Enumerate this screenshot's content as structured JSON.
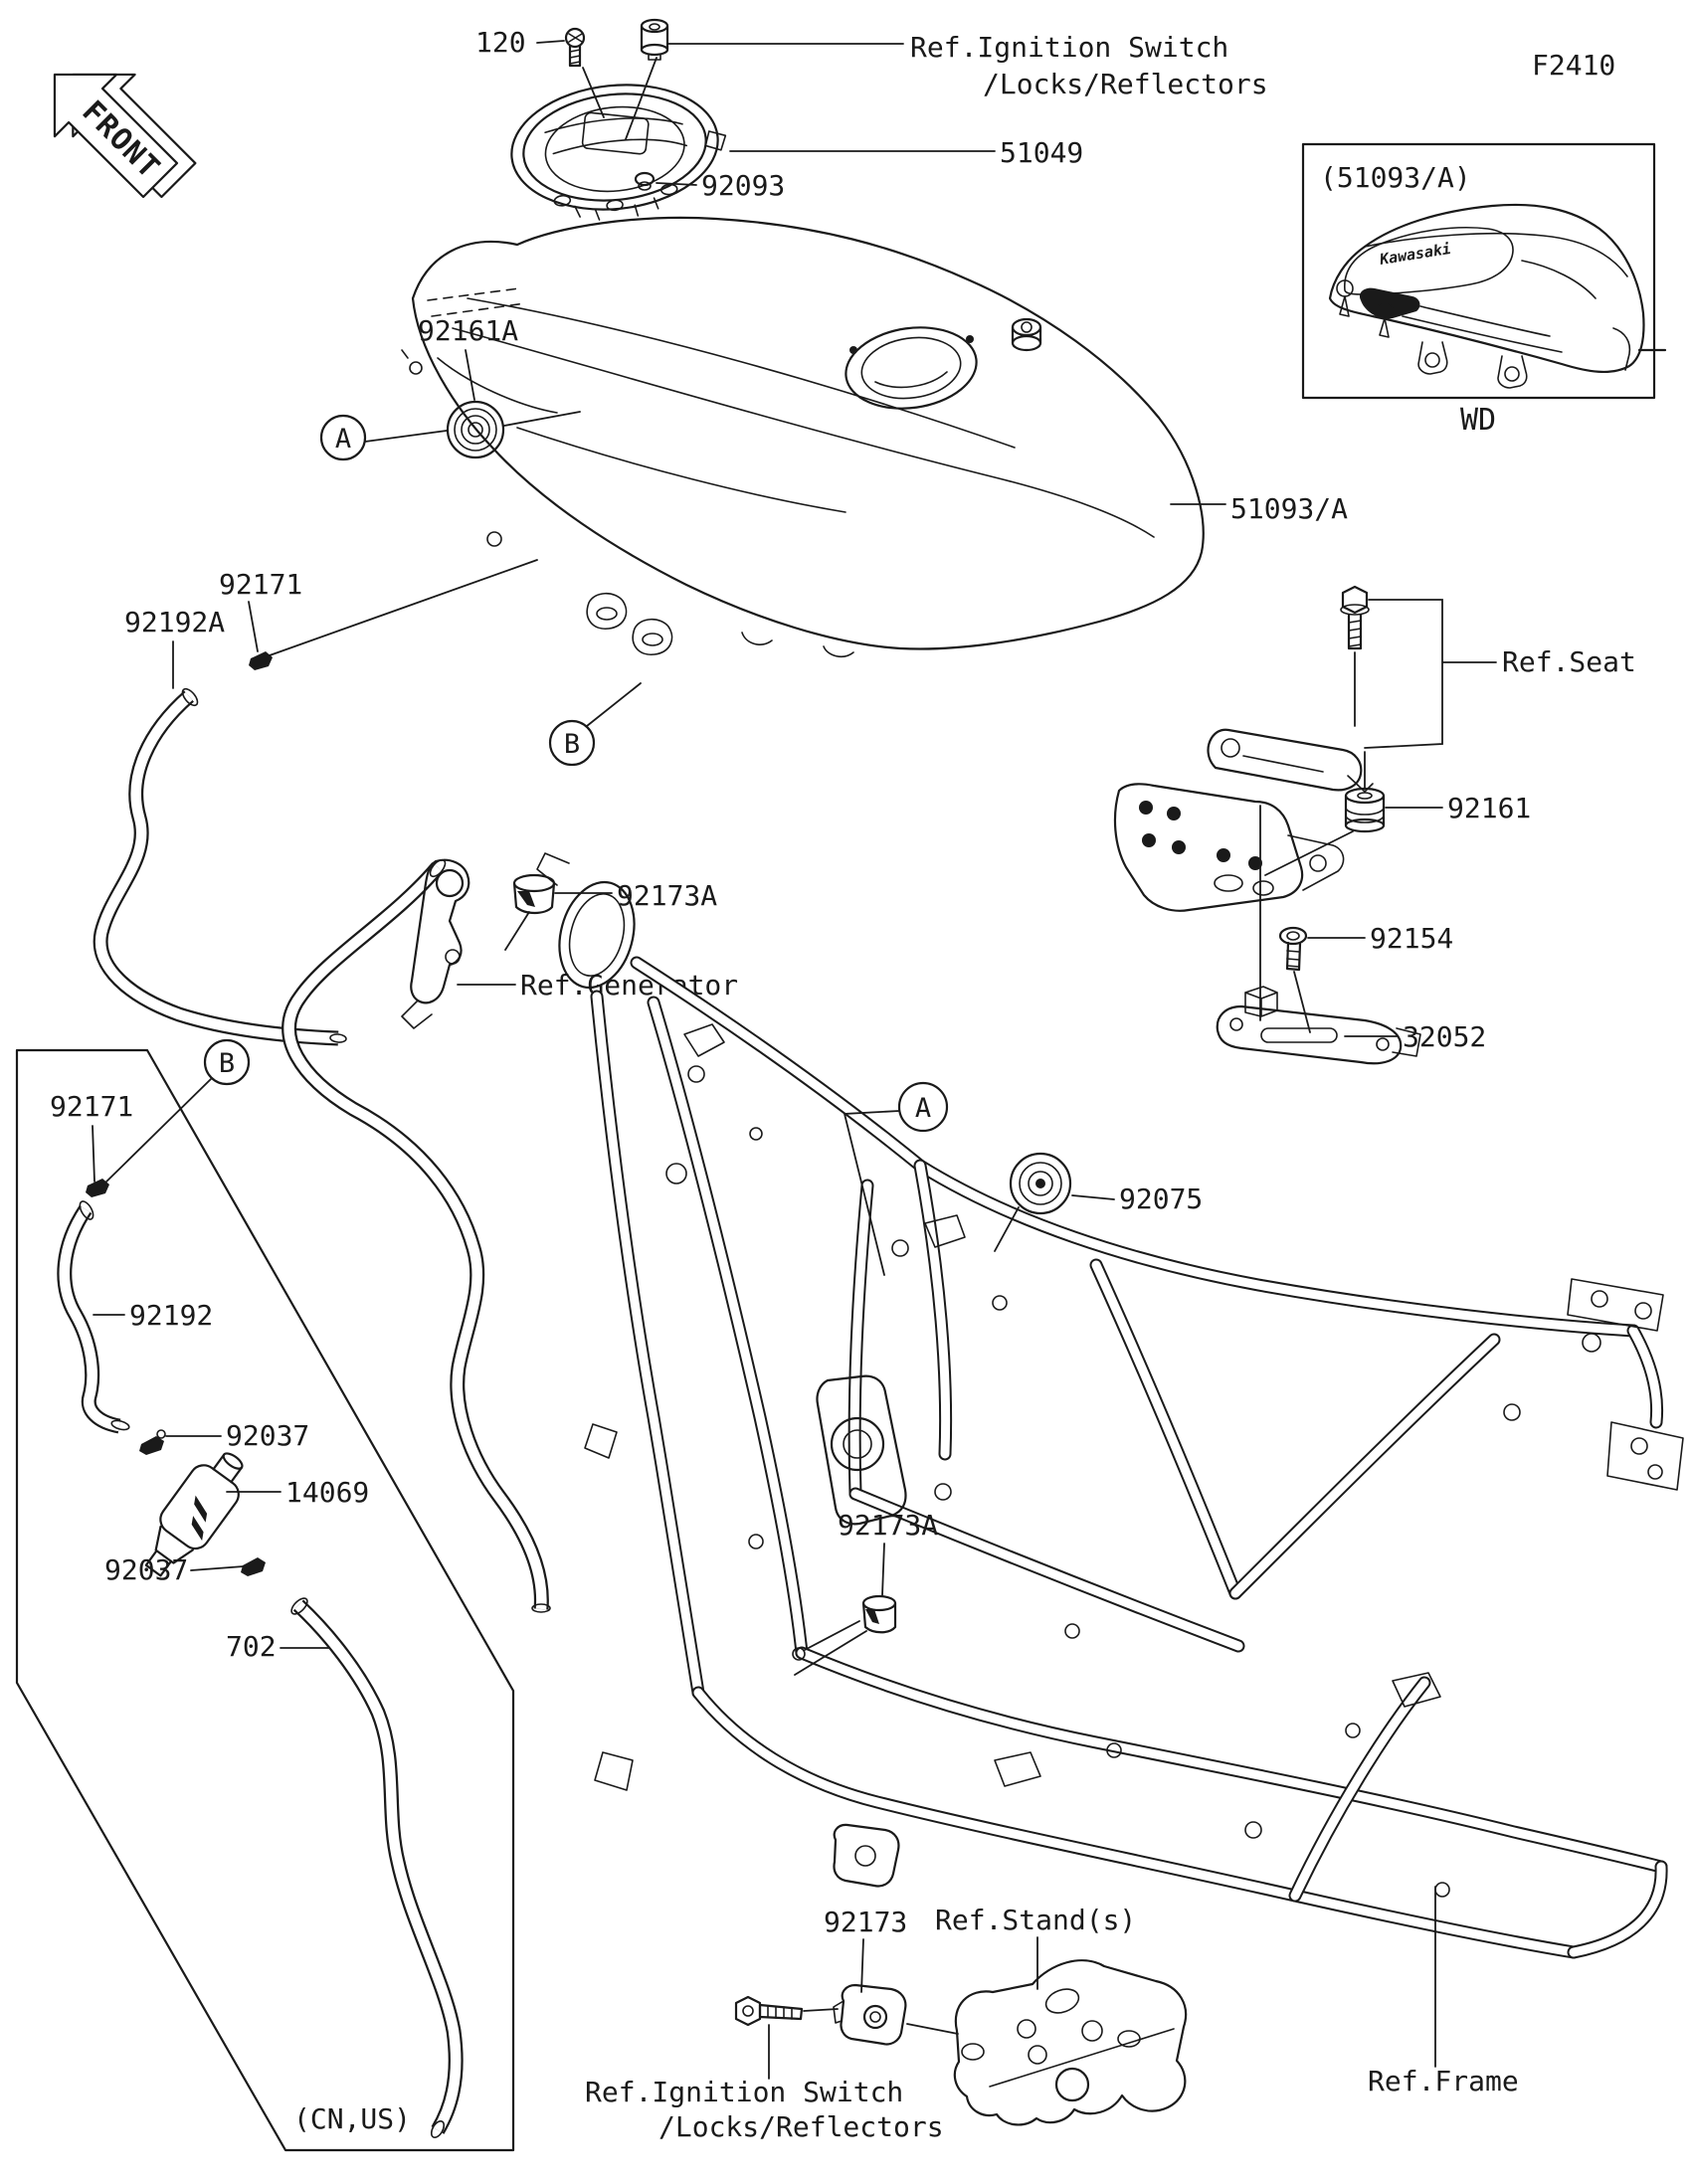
{
  "colors": {
    "background": "#ffffff",
    "line": "#1a1a1a"
  },
  "diagram": {
    "code": "F2410",
    "front_label": "FRONT",
    "inset": {
      "title": "(51093/A)",
      "caption": "WD",
      "brand": "Kawasaki"
    },
    "callouts": {
      "a": "A",
      "b": "B"
    },
    "region_variant": "(CN,US)",
    "parts": {
      "bolt_120": "120",
      "cap_51049": "51049",
      "grommet_92093": "92093",
      "tank_51093": "51093/A",
      "damper_92161a": "92161A",
      "clamp_92171_tank": "92171",
      "hose_92192a": "92192A",
      "damper_92161": "92161",
      "bolt_92154": "92154",
      "bracket_32052": "32052",
      "damper_92173a_generator": "92173A",
      "clamp_92171_filter": "92171",
      "hose_92192": "92192",
      "clamp_92037_upper": "92037",
      "filter_14069": "14069",
      "clamp_92037_lower": "92037",
      "hose_702": "702",
      "grommet_92075": "92075",
      "damper_92173a_frame": "92173A",
      "clamp_92173": "92173"
    },
    "refs": {
      "ignition_top_line1": "Ref.Ignition Switch",
      "ignition_top_line2": "/Locks/Reflectors",
      "seat": "Ref.Seat",
      "generator": "Ref.Generator",
      "stands": "Ref.Stand(s)",
      "ignition_bottom_line1": "Ref.Ignition Switch",
      "ignition_bottom_line2": "/Locks/Reflectors",
      "frame": "Ref.Frame"
    }
  }
}
